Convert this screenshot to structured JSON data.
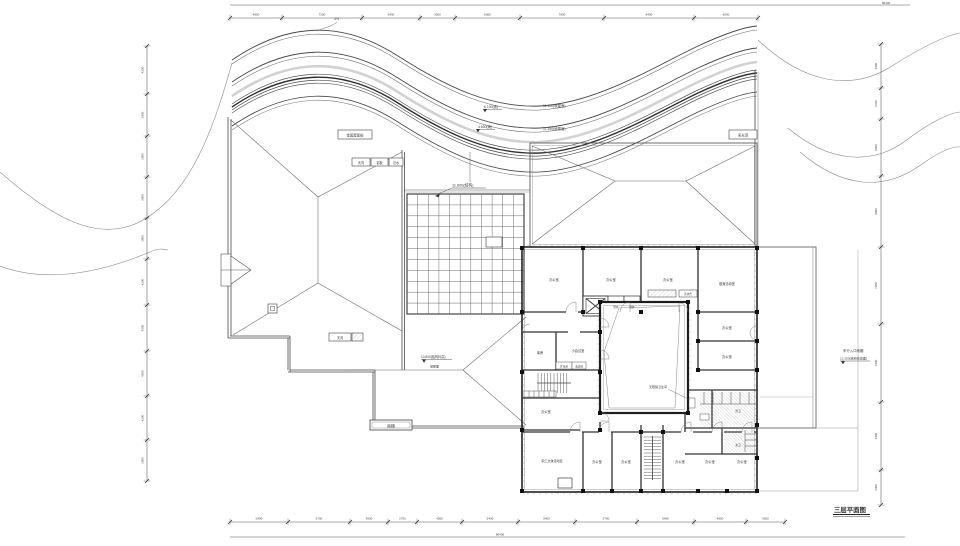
{
  "drawing": {
    "title": {
      "label": "三层平面图"
    },
    "elevations": {
      "skylight": "11.600(结构)",
      "w1": "6.100(坡)",
      "w2": "11.150(坡屋面)",
      "w3": "4.600(坡)",
      "w4": "11.150(坡屋面)",
      "slope": "4%",
      "lower1": "10.800(结构标高)",
      "lower2": "坡屋面",
      "ter1": "车行入口雨棚",
      "ter2": "12.350(结构完成面)"
    },
    "callouts": {
      "roof_panel": "金属屋面板",
      "gutter": "天沟",
      "alum": "铝板",
      "flashing": "泛水",
      "skylight_box": "采光顶",
      "left_gutter": "天沟",
      "canopy_box": "雨棚"
    },
    "rooms": {
      "t1": "办公室",
      "t2": "办公室",
      "t3": "办公室",
      "t4": "健身活动室",
      "r1": "办公室",
      "r2": "办公室",
      "l1": "库房",
      "l2": "小会议室",
      "lb1": "开水间",
      "lb2": "清洁间",
      "l3": "办公室",
      "b1": "职工文体活动室",
      "b2": "办公室",
      "b3": "办公室",
      "b4": "办公室",
      "b5": "办公室",
      "b6": "办公室",
      "core2": "管井",
      "core3": "管井",
      "counter": "茶水台",
      "wc1": "男卫",
      "wc2": "女卫",
      "wc3": "无障碍卫生间"
    },
    "dims": {
      "top_total": "86400",
      "bottom_total": "86400",
      "top": [
        "4800",
        "7200",
        "5400",
        "3000",
        "6000",
        "7800",
        "8400",
        "6000"
      ],
      "bottom": [
        "5400",
        "5700",
        "3600",
        "2700",
        "4200",
        "5400",
        "5400",
        "5700",
        "5400",
        "4800",
        "3600"
      ],
      "left": [
        "4200",
        "3900",
        "3900",
        "3900",
        "3900",
        "4200",
        "4200",
        "4200",
        "4200",
        "3900"
      ],
      "right": [
        "3900",
        "2700",
        "5400",
        "6600",
        "7200",
        "7200",
        "6300",
        "3300"
      ]
    }
  }
}
